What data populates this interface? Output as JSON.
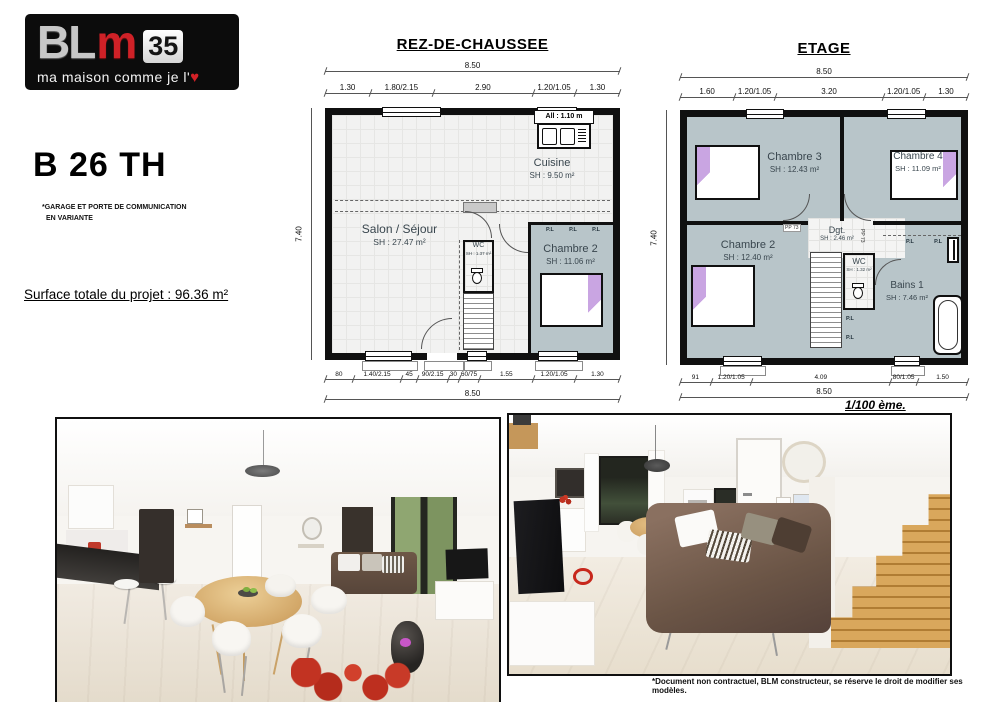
{
  "logo": {
    "bl": "BL",
    "m": "m",
    "num": "35",
    "tagline": "ma maison comme je l'",
    "heart_icon": "♥"
  },
  "project": {
    "title": "B 26 TH",
    "note1": "*GARAGE ET PORTE DE COMMUNICATION",
    "note2": "EN VARIANTE",
    "surface_total": "Surface totale du projet : 96.36 m²"
  },
  "ground_floor": {
    "title": "REZ-DE-CHAUSSEE",
    "overall_top": "8.50",
    "overall_bottom": "8.50",
    "height_dim": "7.40",
    "top_dims": [
      "1.30",
      "1.80/2.15",
      "2.90",
      "1.20/1.05",
      "1.30"
    ],
    "bottom_dims": [
      "80",
      "1.40/2.15",
      "45",
      "90/2.15",
      "30",
      "60/75",
      "1.55",
      "1.20/1.05",
      "1.30"
    ],
    "allege_label": "All : 1.10 m",
    "rooms": {
      "cuisine": {
        "name": "Cuisine",
        "sh": "SH : 9.50 m²"
      },
      "salon": {
        "name": "Salon / Séjour",
        "sh": "SH : 27.47 m²"
      },
      "wc": {
        "name": "WC",
        "sh": "SH : 1.37 m²"
      },
      "chambre2": {
        "name": "Chambre 2",
        "sh": "SH : 11.06 m²"
      }
    },
    "placards": [
      "P.L",
      "P.L",
      "P.L"
    ]
  },
  "etage": {
    "title": "ETAGE",
    "overall_top": "8.50",
    "overall_bottom": "8.50",
    "height_dim": "7.40",
    "top_dims": [
      "1.60",
      "1.20/1.05",
      "3.20",
      "1.20/1.05",
      "1.30"
    ],
    "bottom_dims": [
      "91",
      "1.20/1.05",
      "4.09",
      "80/1.05",
      "1.50"
    ],
    "scale_label": "1/100 ème.",
    "rooms": {
      "chambre3": {
        "name": "Chambre 3",
        "sh": "SH : 12.43 m²"
      },
      "chambre4": {
        "name": "Chambre 4",
        "sh": "SH : 11.09 m²"
      },
      "chambre2": {
        "name": "Chambre 2",
        "sh": "SH : 12.40 m²"
      },
      "dgt": {
        "name": "Dgt.",
        "sh": "SH : 2.46 m²"
      },
      "wc": {
        "name": "WC",
        "sh": "SH : 1.32 m²"
      },
      "bains": {
        "name": "Bains 1",
        "sh": "SH : 7.46 m²"
      }
    },
    "placards_top": [
      "P.L",
      "P.L"
    ],
    "placards_stairs": [
      "P.L",
      "P.L"
    ],
    "door_labels": [
      "PP 73",
      "PP 73"
    ]
  },
  "footer": {
    "disclaimer": "*Document non contractuel, BLM constructeur, se réserve le droit de modifier ses modèles."
  },
  "colors": {
    "room_fill": "#b8c5c9",
    "accent_purple": "#c9a5e2",
    "logo_red": "#cf2127",
    "wall": "#101010"
  }
}
